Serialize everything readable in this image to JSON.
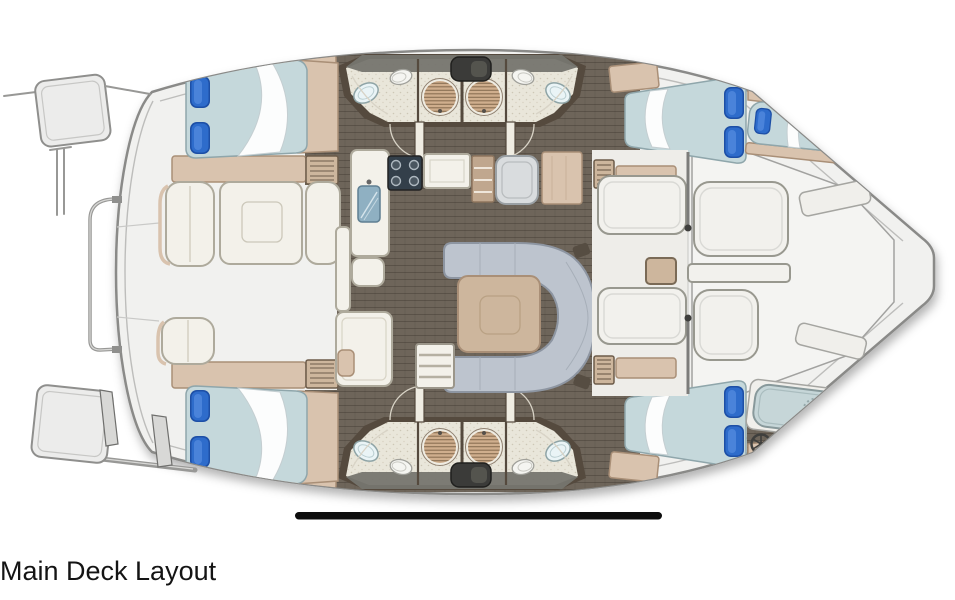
{
  "caption": {
    "text": "Main Deck Layout"
  },
  "diagram": {
    "type": "yacht-floor-plan",
    "vessel": "catamaran",
    "areas": [
      "cockpit lounge with square table (left)",
      "saloon with U-shaped sofa and square table (center)",
      "galley with stove, sink, fridge and counters",
      "4 double-berth cabins with blue pillows",
      "1 single berth (upper right)",
      "4 bathrooms with round shower, sink and toilet",
      "aft deck with benches and cross bench (right)",
      "helm with steering wheel and sun lounger (lower right)",
      "bow platforms with railings (left)"
    ],
    "scale_bar": true
  },
  "palette": {
    "text": "#141414",
    "hull-fill": "#f1f1ef",
    "hull-stroke": "#8a8a88",
    "deck-seam": "#bdbdbb",
    "rail-gray": "#989896",
    "floor-dark": "#6e655a",
    "wall-dark": "#554a3e",
    "bath-floor": "#e9e6da",
    "wood-tan": "#d9c3ae",
    "wood-tan-dark": "#a98f77",
    "wood-mid": "#cdb69d",
    "cream": "#f3f1ea",
    "cream-stroke": "#aeaa9c",
    "mattress": "#c5d8db",
    "mattress-stroke": "#8fa6ab",
    "pillow-blue": "#2e6ccb",
    "pillow-blue-dark": "#1d4fa6",
    "pillow-blue-light": "#4f87dd",
    "sofa-gray": "#bdc4ce",
    "sofa-gray-stroke": "#8d95a1",
    "shower-tan": "#cfae8d",
    "shower-line": "#8a6f52",
    "steel-blue": "#8fb0c2",
    "stove-dark": "#333f4a",
    "hatch-dark": "#3b3b39",
    "bench-white": "#f2f1ed",
    "bench-stroke": "#98988f",
    "bar-black": "#0d0d0d"
  }
}
